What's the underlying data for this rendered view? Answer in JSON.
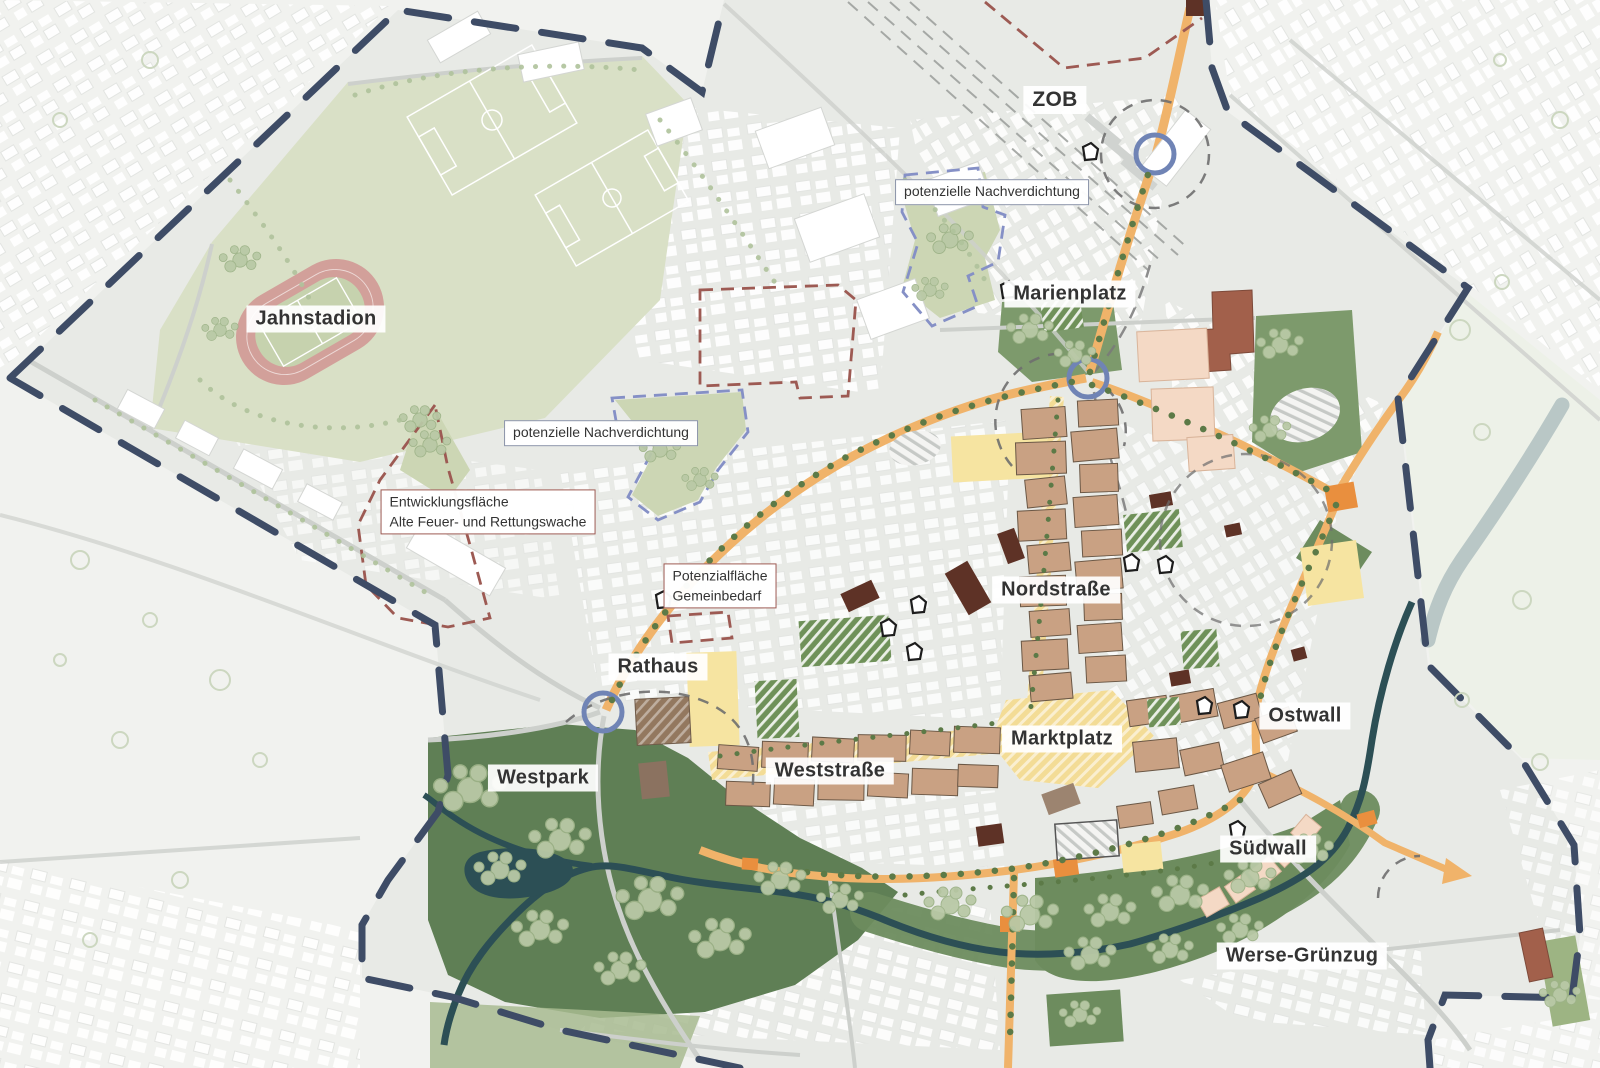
{
  "map": {
    "kind": "urban-development-concept-plan",
    "labels": {
      "zob": "ZOB",
      "marienplatz": "Marienplatz",
      "jahnstadion": "Jahnstadion",
      "nordstrasse": "Nordstraße",
      "rathaus": "Rathaus",
      "marktplatz": "Marktplatz",
      "ostwall": "Ostwall",
      "weststrasse": "Weststraße",
      "westpark": "Westpark",
      "suedwall": "Südwall",
      "werse_gruenzug": "Werse-Grünzug"
    },
    "annotations": {
      "nachverdichtung_nord": "potenzielle Nachverdichtung",
      "nachverdichtung_mitte": "potenzielle Nachverdichtung",
      "entwicklung_line1": "Entwicklungsfläche",
      "entwicklung_line2": "Alte Feuer- und Rettungswache",
      "potenzial_line1": "Potenzialfläche",
      "potenzial_line2": "Gemeinbedarf"
    },
    "colors": {
      "boundary": "#3e4c66",
      "main_road": "#f0b36a",
      "intersection_marker": "#e98f3e",
      "pedestrian_zone": "#f3dc96",
      "special_area_yellow": "#f6e4a1",
      "center_building": "#c9a183",
      "accent_building": "#5e3226",
      "public_building": "#a2604b",
      "new_building_peach": "#f4d9c5",
      "park_dark": "#5f7f55",
      "park_mid": "#7d9a6c",
      "sports_green": "#d9e0c6",
      "running_track": "#d2a09a",
      "river": "#2c4f55",
      "tree": "#b9c9a6",
      "street_tree": "#5c7a47",
      "redevelopment_outline": "#9d5a53",
      "densification_outline": "#8590c6",
      "roundabout": "#7084b5"
    }
  }
}
